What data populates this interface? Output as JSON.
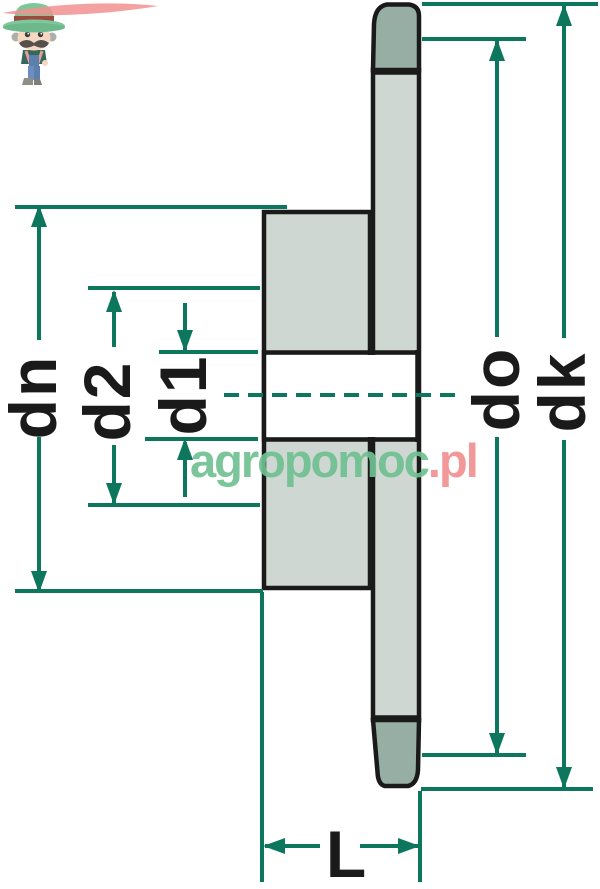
{
  "drawing": {
    "kind": "sprocket cross-section dimension diagram",
    "dimension_labels": {
      "dn": "dn",
      "d2": "d2",
      "d1": "d1",
      "do": "do",
      "dk": "dk",
      "L": "L"
    },
    "colors": {
      "dimension_line": "#0D775D",
      "outline": "#1A1A1A",
      "section_fill_light": "#CED7D1",
      "tooth_fill_dark": "#97AEA4",
      "background": "#FFFFFF"
    }
  },
  "watermark": {
    "text_primary": "agropomoc",
    "text_suffix": ".pl",
    "color_primary": "#6FC191",
    "color_suffix": "#F29090",
    "mascot": "farmer-character"
  }
}
